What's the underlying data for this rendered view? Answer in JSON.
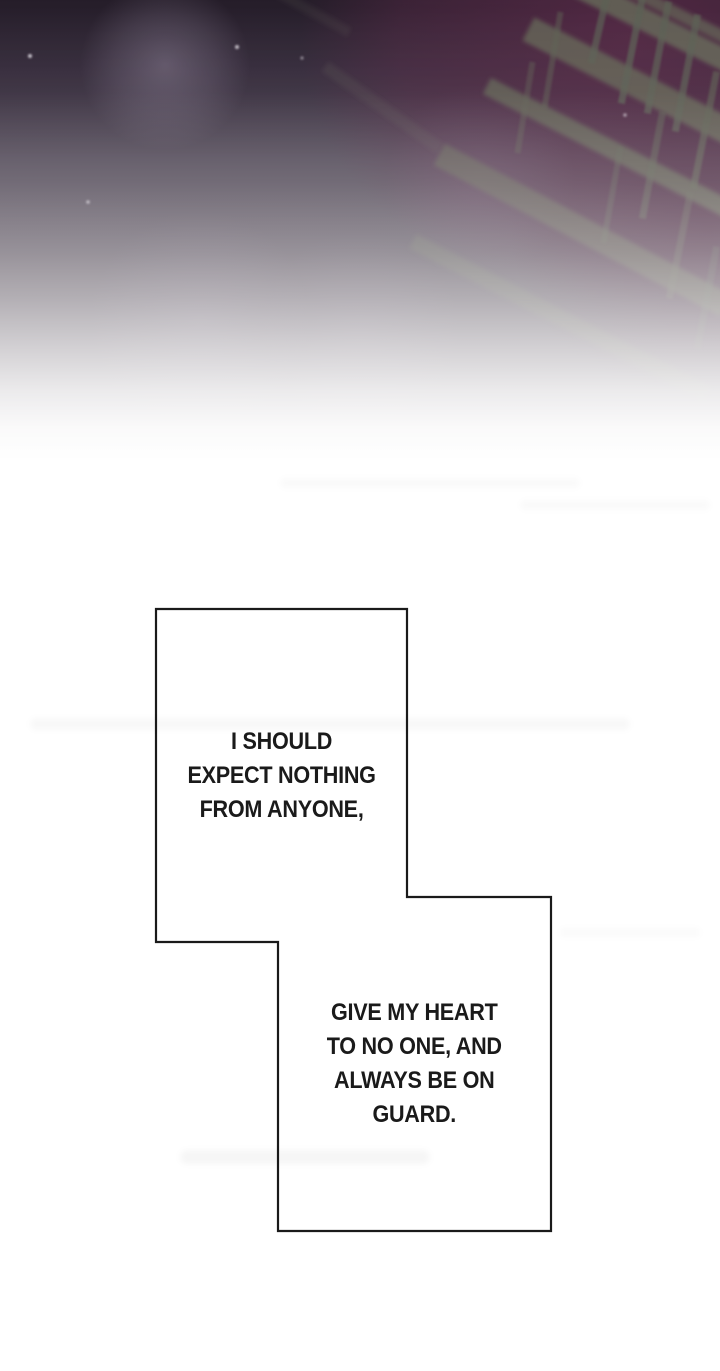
{
  "panels": {
    "box1": {
      "text": "I SHOULD\nEXPECT NOTHING\nFROM ANYONE,"
    },
    "box2": {
      "text": "GIVE MY HEART\nTO NO ONE, AND\nALWAYS BE ON\nGUARD."
    }
  },
  "colors": {
    "background_top": "#251d29",
    "background_maroon": "#562946",
    "beam_gray": "#646757",
    "panel_fill": "#ffffff",
    "panel_border": "#1a1a1a",
    "text_color": "#1a1a1a",
    "page_background": "#ffffff"
  }
}
